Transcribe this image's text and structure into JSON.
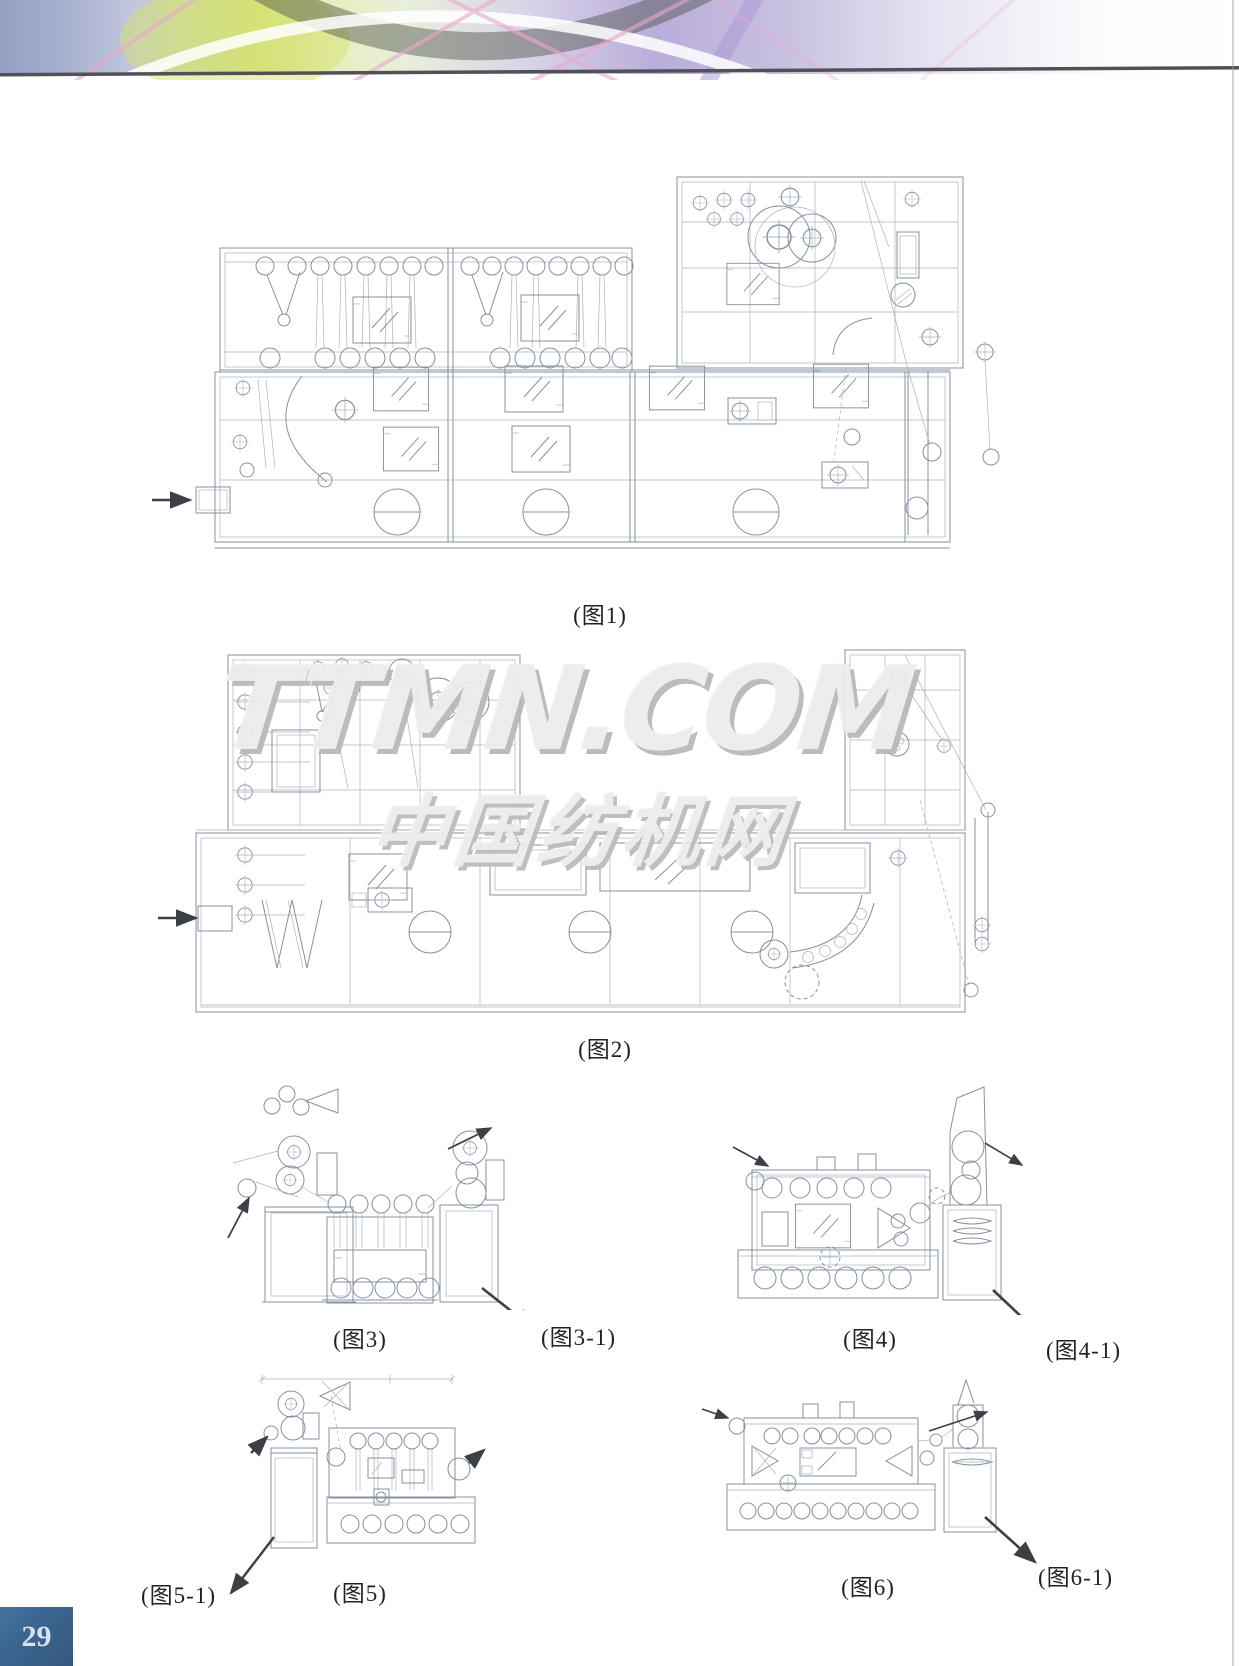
{
  "page": {
    "number": "29"
  },
  "watermark": {
    "line1": "TTMN.COM",
    "line2": "中国纺机网"
  },
  "figures": [
    {
      "id": "figure-1",
      "caption": "(图1)"
    },
    {
      "id": "figure-2",
      "caption": "(图2)"
    },
    {
      "id": "figure-3",
      "caption": "(图3)"
    },
    {
      "id": "figure-3-1",
      "caption": "(图3-1)"
    },
    {
      "id": "figure-4",
      "caption": "(图4)"
    },
    {
      "id": "figure-4-1",
      "caption": "(图4-1)"
    },
    {
      "id": "figure-5",
      "caption": "(图5)"
    },
    {
      "id": "figure-5-1",
      "caption": "(图5-1)"
    },
    {
      "id": "figure-6",
      "caption": "(图6)"
    },
    {
      "id": "figure-6-1",
      "caption": "(图6-1)"
    }
  ],
  "colors": {
    "page_number_bg": "#3a648f",
    "page_number_text": "#d6e0ee",
    "drawing_line": "#8590a0",
    "arrow_line": "#3c3f45",
    "header_rule": "#515258",
    "caption_text": "#1e2226",
    "watermark_fill": "#ececec",
    "watermark_shadow": "#b8b8b8"
  }
}
